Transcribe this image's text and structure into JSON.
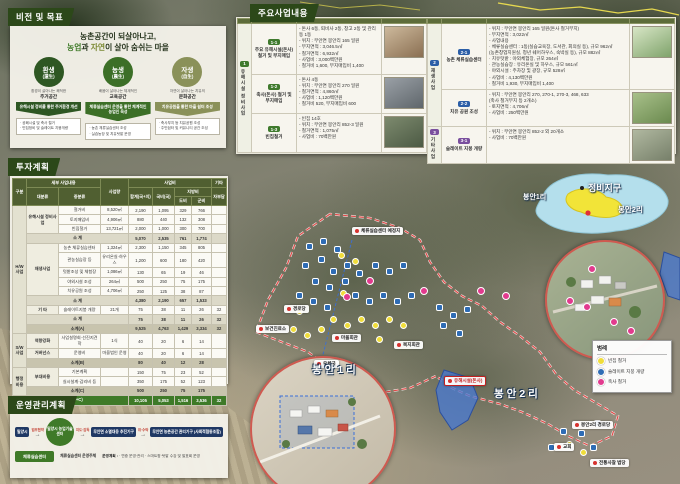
{
  "tabs": {
    "vision": "비전 및 목표",
    "projects": "주요사업내용",
    "invest": "투자계획",
    "ops": "운영관리계획"
  },
  "vision": {
    "title_line1": "농촌공간이 되살아나고,",
    "title_prefix": "농업",
    "title_mid1": "과 ",
    "title_accent2": "자연",
    "title_mid2": "이 살아 숨쉬는 마을",
    "pillars": [
      {
        "main": "환생",
        "sub": "(還生)",
        "color": "#2e5723",
        "cap": "환경이 살아나는 쾌적한",
        "name": "주거공간",
        "arrow": "유해시설 정비를 통한 주거환경 개선",
        "arrow_color": "#2e5723",
        "list": [
          "· 공폐시설 및 축사 철거",
          "· 빈집정비 및 슬레이트 지붕개량"
        ]
      },
      {
        "main": "농생",
        "sub": "(農生)",
        "color": "#3c6f27",
        "cap": "배움이 살아나는 체계적인",
        "name": "교육공간",
        "arrow": "체류실습센터 운영을 통한 체계적인 농업인 육성",
        "arrow_color": "#3c6f27",
        "list": [
          "· 농촌 체류실습센터 조성",
          "· 실습농장 및 치유텃밭 운영"
        ]
      },
      {
        "main": "자생",
        "sub": "(自生)",
        "color": "#8a9159",
        "cap": "자연이 살아나는 치유의",
        "name": "문화공간",
        "arrow": "치유공원을 통한 마을 쉼터 조성",
        "arrow_color": "#8a9159",
        "list": [
          "· 축사부지 등 치유공원 조성",
          "· 주민쉼터 및 커뮤니티 공간 조성"
        ]
      }
    ]
  },
  "projects": {
    "header": {
      "biz": "사업명",
      "sub": "세부사업명",
      "content": "사업내용"
    },
    "left_group": {
      "no": "1",
      "name": "유해시설 정비사업",
      "color": "#3f7a2d"
    },
    "left_rows": [
      {
        "id": "1-1",
        "name": "주요 유해시설(돈사) 철거 및 부지매입",
        "color": "#3f7a2d",
        "details": [
          "- 돈사 6동, 퇴비사 2동, 창고 2동 및 관리동 1동",
          "- 위치 : 무안면 봉안리 165 일원",
          "- 부지면적 : 3,046.5㎡",
          "- 철거면적 : 6,932㎡",
          "- 사업비 : 3,000백만원",
          "  · 철거비 1,600, 부지매입비 1,400"
        ],
        "photo": [
          "#cdb99c",
          "#8a6f52"
        ]
      },
      {
        "id": "1-2",
        "name": "축사(돈사) 철거 및 부지매입",
        "color": "#3f7a2d",
        "details": [
          "- 돈사 4동",
          "- 위치 : 무안면 봉안리 270 일원",
          "- 철거면적 : 4,860㎡",
          "- 사업비 : 1,120백만원",
          "  · 철거비 520, 부지매입비 600"
        ],
        "photo": [
          "#9aa0a6",
          "#5f666b"
        ]
      },
      {
        "id": "1-3",
        "name": "빈집철거",
        "color": "#3f7a2d",
        "details": [
          "- 빈집 14호",
          "- 위치 : 무안면 봉안리 852-3 일원",
          "- 철거면적 : 1,075㎡",
          "- 사업비 : 70백만원"
        ],
        "photo": [
          "#7d8a6e",
          "#4c5a44"
        ]
      }
    ],
    "right_groups": [
      {
        "no": "2",
        "name": "재생사업",
        "color": "#2b5ea7",
        "span": 2
      },
      {
        "no": "3",
        "name": "기타사업",
        "color": "#7a4f9e",
        "span": 1
      }
    ],
    "right_rows": [
      {
        "id": "2-1",
        "name": "농촌 체류실습센터",
        "color": "#2b5ea7",
        "details": [
          "- 위치 : 무안면 봉안리 165 일원(돈사 철거부지)",
          "- 부지면적 : 3,022㎡",
          "- 사업내용",
          "  · 체류실습센터 : 1동(실습교육장, 도서관, 회의실 등), 규모 962㎡",
          "    (농촌창업지원실, 청년 쉐어하우스, 숙박실 등), 규모 882㎡",
          "  · 치유텃밭 : 야외체험장, 규모 264㎡",
          "  · 관농실습장 : 유리온실 및 하우스, 규모 561㎡",
          "  · 야외시설 : 주차장 및 광장, 규모 528㎡",
          "- 사업비 : 4,130백만원",
          "  · 철거비 1,930, 부지매입비 1,400"
        ],
        "photo": [
          "#d8e6c6",
          "#7fa36b"
        ]
      },
      {
        "id": "2-2",
        "name": "치유 공원 조성",
        "color": "#2b5ea7",
        "details": [
          "- 위치 : 무안면 봉안리 270, 270-1, 270-3, 468, 633",
          "  (축사 철거부지 등 2개소)",
          "- 토지면적 : 4,706㎡",
          "- 사업비 : 250백만원"
        ],
        "photo": [
          "#a8c08a",
          "#6b8a4f"
        ]
      },
      {
        "id": "3-1",
        "name": "슬레이트 지붕 개량",
        "color": "#7a4f9e",
        "details": [
          "- 위치 : 무안면 봉안리 852-2 외 20개소",
          "- 사업비 : 70백만원"
        ],
        "photo": [
          "#b0b8a0",
          "#77806a"
        ]
      }
    ]
  },
  "invest": {
    "header": {
      "gubun": "구분",
      "detail": "세부 사업내용",
      "dae": "대분류",
      "jung": "중분류",
      "qty": "사업량",
      "cost": "사업비",
      "total": "합계(국+지)",
      "nat": "국비(국)",
      "local": "지방비",
      "do": "도비",
      "gun": "군비",
      "etc": "기타",
      "self": "자부담"
    },
    "rows": [
      {
        "cells": [
          {
            "t": "H/W 사업",
            "rs": 13,
            "cls": "cat"
          },
          {
            "t": "유해시설 정비사업",
            "rs": 3,
            "cls": "dae"
          },
          {
            "t": "철거비"
          },
          {
            "t": "8,520㎡"
          },
          {
            "t": "2,190"
          },
          {
            "t": "1,095"
          },
          {
            "t": "329"
          },
          {
            "t": "766"
          },
          {
            "t": ""
          }
        ]
      },
      {
        "cells": [
          {
            "t": "토지매입비"
          },
          {
            "t": "4,906㎡"
          },
          {
            "t": "880"
          },
          {
            "t": "440"
          },
          {
            "t": "132"
          },
          {
            "t": "308"
          },
          {
            "t": ""
          }
        ]
      },
      {
        "cells": [
          {
            "t": "빈집철거"
          },
          {
            "t": "13,721㎡"
          },
          {
            "t": "2,000"
          },
          {
            "t": "1,000"
          },
          {
            "t": "300"
          },
          {
            "t": "700"
          },
          {
            "t": ""
          }
        ]
      },
      {
        "cls": "sub",
        "cells": [
          {
            "t": "소  계",
            "cs": 3
          },
          {
            "t": "5,070"
          },
          {
            "t": "2,535"
          },
          {
            "t": "761"
          },
          {
            "t": "1,774"
          },
          {
            "t": ""
          }
        ]
      },
      {
        "cells": [
          {
            "t": "재생사업",
            "rs": 5,
            "cls": "dae"
          },
          {
            "t": "농촌 체류실습센터"
          },
          {
            "t": "1,324㎡"
          },
          {
            "t": "2,300"
          },
          {
            "t": "1,150"
          },
          {
            "t": "345"
          },
          {
            "t": "805"
          },
          {
            "t": ""
          }
        ]
      },
      {
        "cells": [
          {
            "t": "관농실습장 등"
          },
          {
            "t": "유리온실·하우스"
          },
          {
            "t": "1,200"
          },
          {
            "t": "600"
          },
          {
            "t": "180"
          },
          {
            "t": "420"
          },
          {
            "t": ""
          }
        ]
      },
      {
        "cells": [
          {
            "t": "텃밭조성 및 체험장"
          },
          {
            "t": "1,086㎡"
          },
          {
            "t": "130"
          },
          {
            "t": "65"
          },
          {
            "t": "19"
          },
          {
            "t": "46"
          },
          {
            "t": ""
          }
        ]
      },
      {
        "cells": [
          {
            "t": "야외시설 조성"
          },
          {
            "t": "264㎡"
          },
          {
            "t": "500"
          },
          {
            "t": "250"
          },
          {
            "t": "75"
          },
          {
            "t": "175"
          },
          {
            "t": ""
          }
        ]
      },
      {
        "cells": [
          {
            "t": "치유공원 조성"
          },
          {
            "t": "4,706㎡"
          },
          {
            "t": "250"
          },
          {
            "t": "125"
          },
          {
            "t": "38"
          },
          {
            "t": "87"
          },
          {
            "t": ""
          }
        ]
      },
      {
        "cls": "sub",
        "cells": [
          {
            "t": "소  계",
            "cs": 3
          },
          {
            "t": "4,380"
          },
          {
            "t": "2,190"
          },
          {
            "t": "657"
          },
          {
            "t": "1,533"
          },
          {
            "t": ""
          }
        ]
      },
      {
        "cells": [
          {
            "t": "기  타",
            "cls": "dae"
          },
          {
            "t": "슬레이트지붕 개량"
          },
          {
            "t": "21개"
          },
          {
            "t": "75"
          },
          {
            "t": "38"
          },
          {
            "t": "11"
          },
          {
            "t": "26"
          },
          {
            "t": "32"
          }
        ]
      },
      {
        "cls": "sub",
        "cells": [
          {
            "t": "소  계",
            "cs": 3
          },
          {
            "t": "75"
          },
          {
            "t": "38"
          },
          {
            "t": "11"
          },
          {
            "t": "26"
          },
          {
            "t": "32"
          }
        ]
      },
      {
        "cls": "subA",
        "cells": [
          {
            "t": "소계(A)",
            "cs": 3
          },
          {
            "t": "9,525"
          },
          {
            "t": "4,763"
          },
          {
            "t": "1,429"
          },
          {
            "t": "3,334"
          },
          {
            "t": "32"
          }
        ]
      },
      {
        "cells": [
          {
            "t": "S/W 사업",
            "rs": 3,
            "cls": "cat"
          },
          {
            "t": "역량강화",
            "cls": "dae"
          },
          {
            "t": "사업설명회·선진지견학"
          },
          {
            "t": "1식"
          },
          {
            "t": "40"
          },
          {
            "t": "20"
          },
          {
            "t": "6"
          },
          {
            "t": "14"
          },
          {
            "t": ""
          }
        ]
      },
      {
        "cells": [
          {
            "t": "거버넌스",
            "cls": "dae"
          },
          {
            "t": "운영비"
          },
          {
            "t": "마을법인 운영"
          },
          {
            "t": "40"
          },
          {
            "t": "20"
          },
          {
            "t": "6"
          },
          {
            "t": "14"
          },
          {
            "t": ""
          }
        ]
      },
      {
        "cls": "subA",
        "cells": [
          {
            "t": "소계(B)",
            "cs": 3
          },
          {
            "t": "80"
          },
          {
            "t": "40"
          },
          {
            "t": "12"
          },
          {
            "t": "28"
          },
          {
            "t": ""
          }
        ]
      },
      {
        "cells": [
          {
            "t": "행정 비용",
            "rs": 3,
            "cls": "cat"
          },
          {
            "t": "부대비용",
            "rs": 2,
            "cls": "dae"
          },
          {
            "t": "기본계획"
          },
          {
            "t": ""
          },
          {
            "t": "150"
          },
          {
            "t": "75"
          },
          {
            "t": "23"
          },
          {
            "t": "52"
          },
          {
            "t": ""
          }
        ]
      },
      {
        "cells": [
          {
            "t": "실시설계·감리비 등"
          },
          {
            "t": ""
          },
          {
            "t": "350"
          },
          {
            "t": "175"
          },
          {
            "t": "52"
          },
          {
            "t": "123"
          },
          {
            "t": ""
          }
        ]
      },
      {
        "cls": "subA",
        "cells": [
          {
            "t": "소계(C)",
            "cs": 3
          },
          {
            "t": "500"
          },
          {
            "t": "250"
          },
          {
            "t": "75"
          },
          {
            "t": "175"
          },
          {
            "t": ""
          }
        ]
      },
      {
        "cls": "total",
        "cells": [
          {
            "t": "합계(A+B+C)",
            "cs": 4
          },
          {
            "t": "10,105"
          },
          {
            "t": "5,053"
          },
          {
            "t": "1,516"
          },
          {
            "t": "3,536"
          },
          {
            "t": "32"
          }
        ]
      }
    ]
  },
  "ops": {
    "flow": [
      {
        "type": "box",
        "label": "밀양시"
      },
      {
        "type": "arrow",
        "label": "업무협약"
      },
      {
        "type": "circle",
        "label": "밀양시 농업기술센터"
      },
      {
        "type": "arrow",
        "label": "지도·감독"
      },
      {
        "type": "box",
        "label": "무안면 소멸대응 추진기구"
      },
      {
        "type": "arrow",
        "label": "위·수탁"
      },
      {
        "type": "box",
        "label": "무안면 농촌공간 관리기구 (사회적협동조합)"
      }
    ],
    "bottom": {
      "note": "체류실습센터 운영주체",
      "box": "체류실습센터",
      "plan_title": "운영계획 :",
      "plan_items": "· 연중 운영·관리  · 스마트팜·텃밭 수강 및 발표회 운영"
    }
  },
  "map": {
    "minimap": {
      "left_label": "봉안1리",
      "center_label": "정비지구",
      "right_label": "봉안2리"
    },
    "legend": {
      "title": "범례",
      "items": [
        {
          "color": "#f0dd3a",
          "label": "빈집 철거"
        },
        {
          "color": "#2e6cb5",
          "label": "슬레이트 지붕 개량"
        },
        {
          "color": "#e23a8e",
          "label": "축사 철거"
        }
      ]
    },
    "big_labels": [
      {
        "x": 312,
        "y": 362,
        "t": "봉안1리"
      },
      {
        "x": 494,
        "y": 386,
        "t": "봉안2리"
      }
    ],
    "pills": [
      {
        "x": 352,
        "y": 227,
        "t": "체류실습센터 예정지"
      },
      {
        "x": 284,
        "y": 305,
        "t": "경로당"
      },
      {
        "x": 256,
        "y": 325,
        "t": "보건진료소"
      },
      {
        "x": 332,
        "y": 334,
        "t": "마을회관"
      },
      {
        "x": 394,
        "y": 341,
        "t": "복지회관"
      },
      {
        "x": 314,
        "y": 360,
        "t": "우체국"
      },
      {
        "x": 572,
        "y": 421,
        "t": "봉안2리 경로당"
      },
      {
        "x": 554,
        "y": 443,
        "t": "교회"
      },
      {
        "x": 590,
        "y": 459,
        "t": "전통사찰 법당"
      }
    ],
    "hazard_labels": [
      {
        "x": 444,
        "y": 376,
        "t": "유해시설(돈사)"
      }
    ],
    "markers": {
      "slate": [
        [
          306,
          243
        ],
        [
          320,
          238
        ],
        [
          334,
          246
        ],
        [
          318,
          256
        ],
        [
          302,
          262
        ],
        [
          330,
          268
        ],
        [
          344,
          262
        ],
        [
          312,
          278
        ],
        [
          326,
          284
        ],
        [
          342,
          278
        ],
        [
          356,
          270
        ],
        [
          296,
          292
        ],
        [
          310,
          298
        ],
        [
          324,
          304
        ],
        [
          352,
          292
        ],
        [
          366,
          298
        ],
        [
          380,
          292
        ],
        [
          394,
          298
        ],
        [
          408,
          292
        ],
        [
          372,
          262
        ],
        [
          386,
          268
        ],
        [
          400,
          262
        ],
        [
          436,
          304
        ],
        [
          450,
          312
        ],
        [
          464,
          306
        ],
        [
          440,
          322
        ],
        [
          456,
          330
        ],
        [
          594,
          420
        ],
        [
          578,
          430
        ],
        [
          560,
          428
        ],
        [
          548,
          444
        ],
        [
          590,
          444
        ]
      ],
      "vacant": [
        [
          338,
          252
        ],
        [
          352,
          258
        ],
        [
          296,
          308
        ],
        [
          340,
          290
        ],
        [
          330,
          316
        ],
        [
          344,
          322
        ],
        [
          358,
          316
        ],
        [
          372,
          322
        ],
        [
          386,
          316
        ],
        [
          400,
          322
        ],
        [
          290,
          326
        ],
        [
          304,
          332
        ],
        [
          318,
          326
        ],
        [
          376,
          336
        ],
        [
          566,
          441
        ],
        [
          580,
          449
        ]
      ],
      "barn": [
        [
          366,
          277
        ],
        [
          420,
          287
        ],
        [
          477,
          287
        ],
        [
          502,
          292
        ],
        [
          566,
          297
        ],
        [
          583,
          303
        ],
        [
          588,
          265
        ],
        [
          610,
          318
        ],
        [
          627,
          327
        ],
        [
          343,
          293
        ]
      ]
    }
  }
}
